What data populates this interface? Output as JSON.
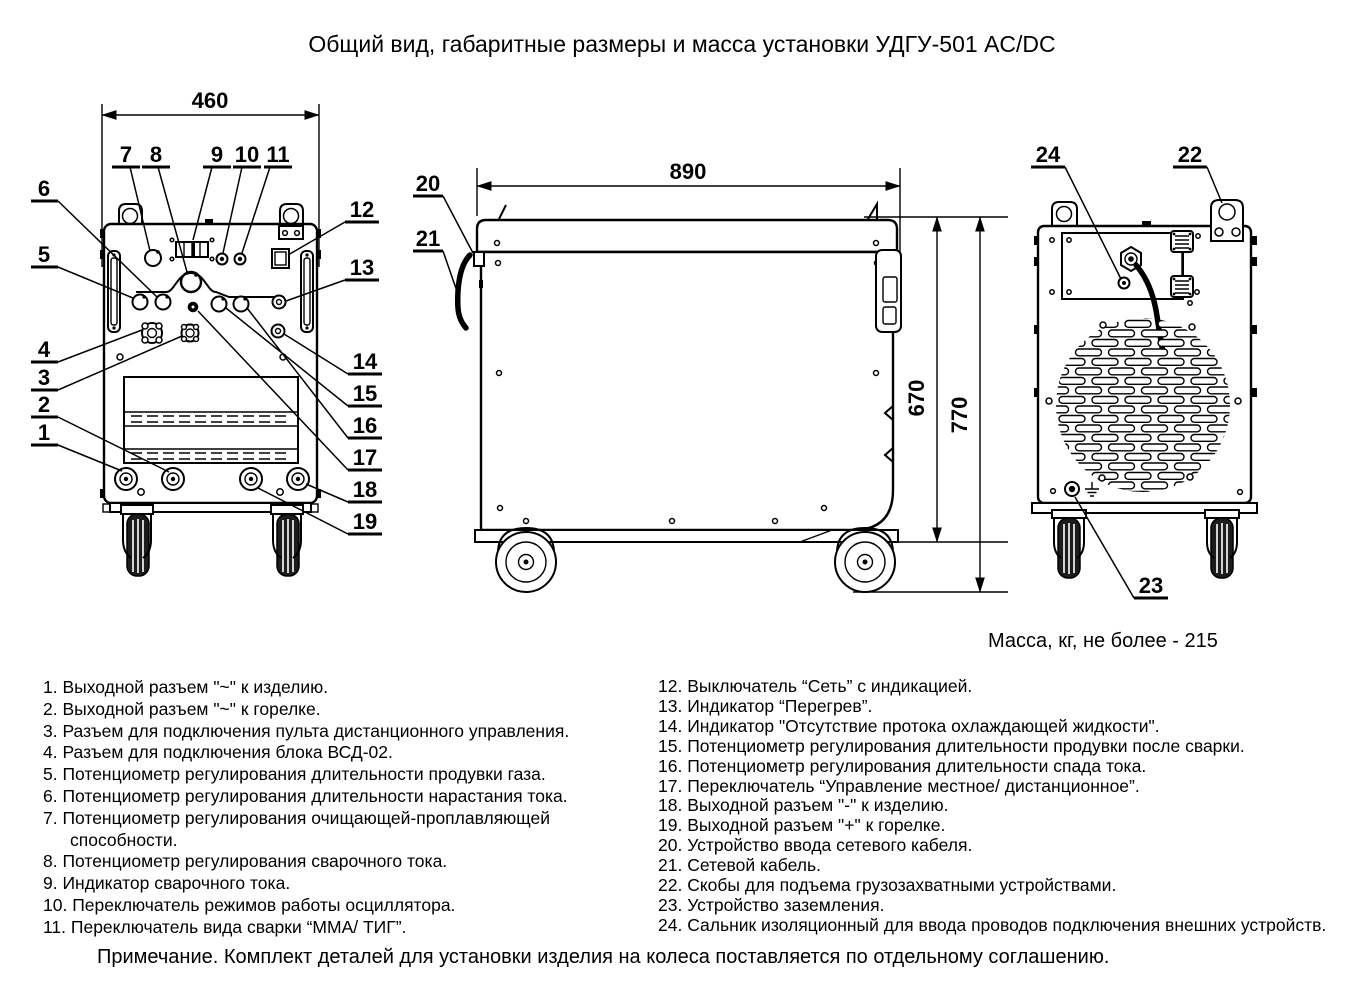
{
  "title": "Общий вид, габаритные размеры и масса установки УДГУ-501 AC/DC",
  "dimensions": {
    "front_width": "460",
    "depth": "890",
    "body_height": "670",
    "overall_height": "770"
  },
  "mass_note": "Масса, кг, не более - 215",
  "callouts": {
    "c1": "1",
    "c2": "2",
    "c3": "3",
    "c4": "4",
    "c5": "5",
    "c6": "6",
    "c7": "7",
    "c8": "8",
    "c9": "9",
    "c10": "10",
    "c11": "11",
    "c12": "12",
    "c13": "13",
    "c14": "14",
    "c15": "15",
    "c16": "16",
    "c17": "17",
    "c18": "18",
    "c19": "19",
    "c20": "20",
    "c21": "21",
    "c22": "22",
    "c23": "23",
    "c24": "24"
  },
  "legend_left": [
    "1. Выходной разъем \"~\" к изделию.",
    "2. Выходной разъем \"~\" к горелке.",
    "3. Разъем для подключения пульта дистанционного управления.",
    "4. Разъем для подключения блока ВСД-02.",
    "5. Потенциометр регулирования длительности продувки газа.",
    "6. Потенциометр регулирования длительности нарастания тока.",
    "7. Потенциометр регулирования очищающей-проплавляющей способности.",
    "8. Потенциометр регулирования сварочного тока.",
    "9. Индикатор сварочного тока.",
    "10. Переключатель режимов работы осциллятора.",
    "11. Переключатель вида сварки “ММА/ ТИГ”."
  ],
  "legend_right": [
    "12. Выключатель “Сеть” с индикацией.",
    "13. Индикатор “Перегрев”.",
    "14. Индикатор \"Отсутствие протока охлаждающей жидкости\".",
    "15. Потенциометр регулирования длительности продувки после сварки.",
    "16. Потенциометр регулирования длительности  спада тока.",
    "17. Переключатель “Управление местное/ дистанционное”.",
    "18. Выходной разъем \"-\" к изделию.",
    "19. Выходной разъем \"+\" к горелке.",
    "20. Устройство ввода сетевого кабеля.",
    "21. Сетевой кабель.",
    "22. Скобы для подъема грузозахватными устройствами.",
    "23. Устройство заземления.",
    "24. Сальник изоляционный для ввода проводов подключения внешних устройств."
  ],
  "footnote": "Примечание. Комплект деталей для установки изделия на колеса поставляется по отдельному соглашению."
}
